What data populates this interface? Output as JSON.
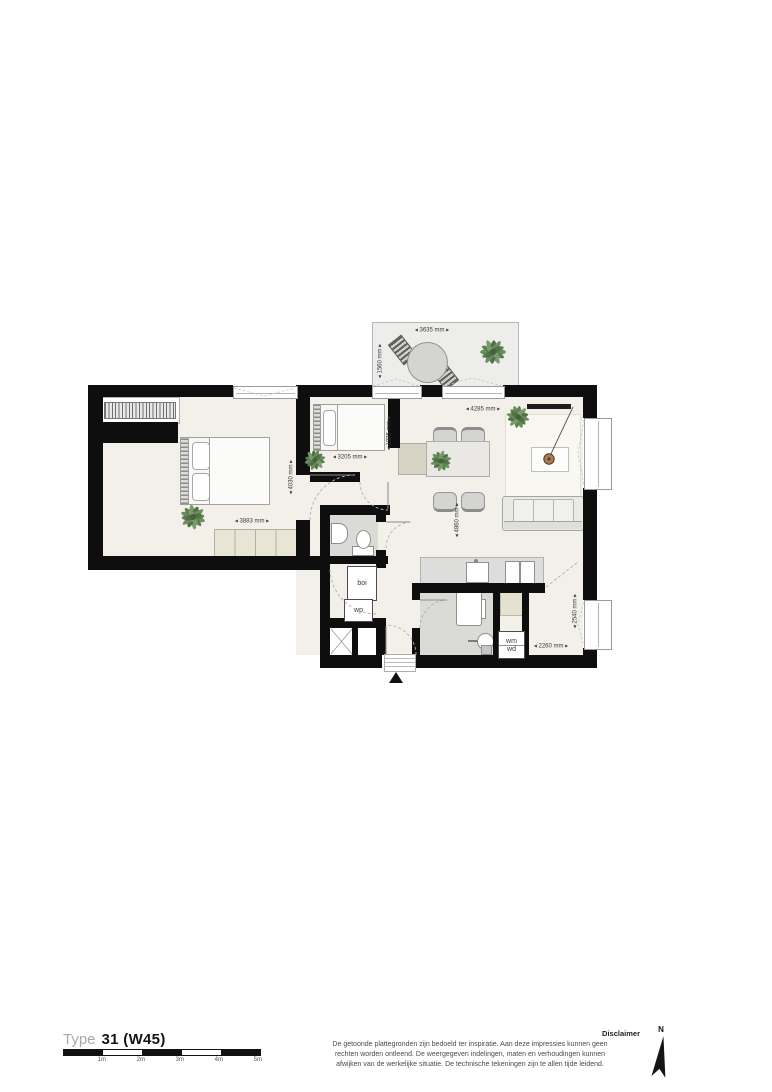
{
  "title": {
    "prefix": "Type",
    "code": "31 (W45)"
  },
  "scalebar": {
    "labels": [
      "1m",
      "2m",
      "3m",
      "4m",
      "5m"
    ]
  },
  "disclaimer": {
    "title": "Disclaimer",
    "line1": "De getoonde plattegronden zijn bedoeld ter inspiratie. Aan deze impressies kunnen geen",
    "line2": "rechten worden ontleend. De weergegeven indelingen, maten en verhoudingen kunnen",
    "line3": "afwijken van de werkelijke situatie. De technische tekeningen zijn te allen tijde leidend."
  },
  "compass": {
    "label": "N"
  },
  "plan": {
    "dims": [
      {
        "id": "balcony-width",
        "text": "◂ 3635 mm ▸"
      },
      {
        "id": "balcony-depth",
        "text": "◂ 1560 mm ▸"
      },
      {
        "id": "bedroom1-width",
        "text": "◂ 3883 mm ▸"
      },
      {
        "id": "bedroom1-depth",
        "text": "◂ 4030 mm ▸"
      },
      {
        "id": "bedroom2-width",
        "text": "◂ 3205 mm ▸"
      },
      {
        "id": "bedroom2-depth",
        "text": "◂ 1835 mm ▸"
      },
      {
        "id": "living-width",
        "text": "◂ 4285 mm ▸"
      },
      {
        "id": "living-depth",
        "text": "◂ 4860 mm ▸"
      },
      {
        "id": "hall-width",
        "text": "◂ 2260 mm ▸"
      },
      {
        "id": "hall-depth",
        "text": "◂ 2540 mm ▸"
      }
    ],
    "equipment": {
      "boiler": "boi",
      "heat_pump": "wp",
      "washer": "wm",
      "dryer": "wd"
    }
  }
}
